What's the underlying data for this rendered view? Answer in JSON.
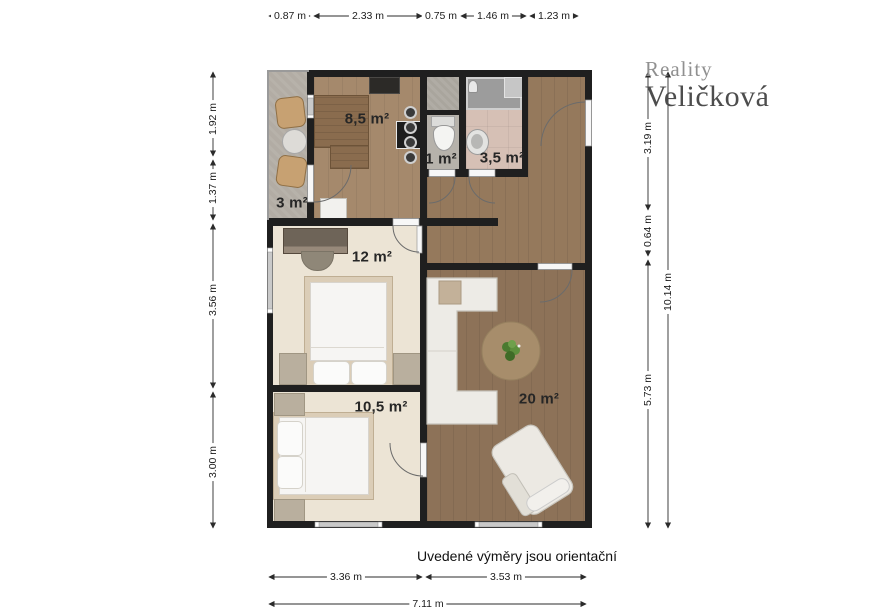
{
  "branding": {
    "line1": "Reality",
    "line2": "Veličková"
  },
  "disclaimer": "Uvedené výměry jsou orientační",
  "rooms": {
    "kitchen": {
      "label": "8,5 m²"
    },
    "wc": {
      "label": "1 m²"
    },
    "bathroom": {
      "label": "3,5 m²"
    },
    "balcony": {
      "label": "3 m²"
    },
    "bedroom_large": {
      "label": "12 m²"
    },
    "bedroom_small": {
      "label": "10,5 m²"
    },
    "living_room": {
      "label": "20 m²"
    }
  },
  "dimensions": {
    "top": [
      "0.87 m",
      "2.33 m",
      "0.75 m",
      "1.46 m",
      "1.23 m"
    ],
    "left": [
      "1.92 m",
      "1.37 m",
      "3.56 m",
      "3.00 m"
    ],
    "right_inner": [
      "3.19 m",
      "0.64 m",
      "5.73 m"
    ],
    "right_total": "10.14 m",
    "bottom": [
      "3.36 m",
      "3.53 m"
    ],
    "bottom_total": "7.11 m"
  },
  "colors": {
    "wall": "#1f1f1f",
    "wood_kitchen": "#a5896c",
    "wood_hall": "#95795c",
    "wood_living": "#8d7258",
    "floor_bedroom": "#ece4d5",
    "floor_bath": "#d6c0b5",
    "concrete_balcony": "#b2aca4",
    "furniture_white": "#f2f1ee",
    "counter_wood": "#8a6c4e",
    "logo_gray": "#909090",
    "logo_dark": "#4d4d4d"
  }
}
